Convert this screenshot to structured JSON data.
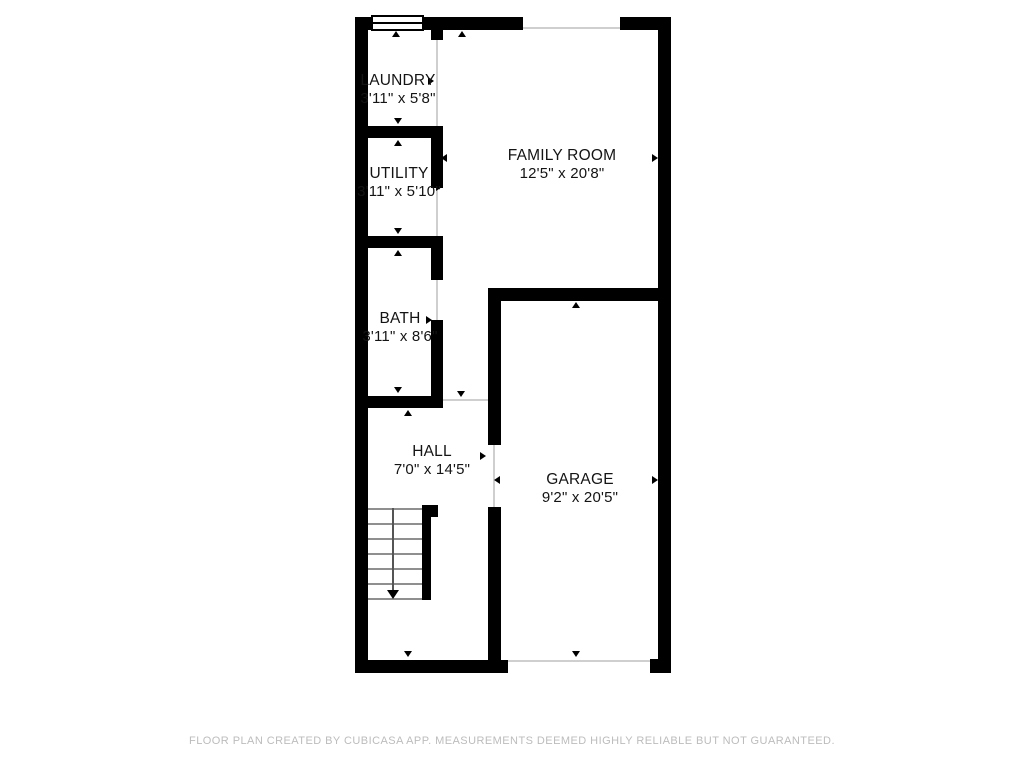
{
  "plan": {
    "source": "floor-plan",
    "rooms": [
      {
        "id": "laundry",
        "name": "LAUNDRY",
        "dimensions": "3'11\" x 5'8\""
      },
      {
        "id": "utility",
        "name": "UTILITY",
        "dimensions": "3'11\" x 5'10\""
      },
      {
        "id": "bath",
        "name": "BATH",
        "dimensions": "3'11\" x 8'6\""
      },
      {
        "id": "family_room",
        "name": "FAMILY ROOM",
        "dimensions": "12'5\" x 20'8\""
      },
      {
        "id": "hall",
        "name": "HALL",
        "dimensions": "7'0\" x 14'5\""
      },
      {
        "id": "garage",
        "name": "GARAGE",
        "dimensions": "9'2\" x 20'5\""
      }
    ],
    "colors": {
      "wall": "#000000",
      "opening_line": "#cfcfcf",
      "stair_line": "#8f8f8f",
      "label_text": "#141414",
      "footer_text": "#bcbcbc",
      "background": "#ffffff"
    }
  },
  "footer": {
    "disclaimer": "FLOOR PLAN CREATED BY CUBICASA APP. MEASUREMENTS DEEMED HIGHLY RELIABLE BUT NOT GUARANTEED."
  }
}
